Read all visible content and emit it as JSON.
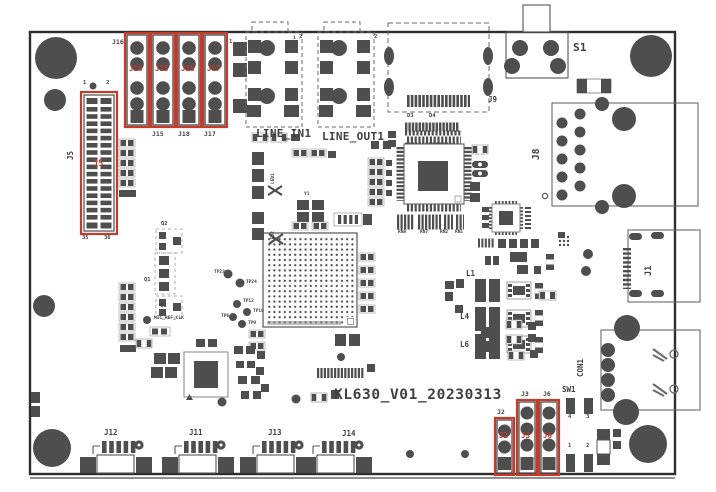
{
  "title": "KL630_V01_20230313",
  "colors": {
    "highlight": "#c23b2b",
    "silk": "#4e4e4e",
    "outline": "#2e2e2e"
  },
  "top_headers": {
    "silk_top_label": "J16",
    "pin1": "1",
    "red_labels": [
      "J16",
      "J15",
      "J18",
      "J17"
    ],
    "silk_bottom_labels": [
      "J15",
      "J18",
      "J17"
    ]
  },
  "j5": {
    "silk": "J5",
    "red": "J5",
    "pins": {
      "tl": "1",
      "tr": "2",
      "bl": "35",
      "br": "36"
    }
  },
  "audio": {
    "line_in": "LINE_IN1",
    "line_out": "LINE_OUT1",
    "pin1": "1",
    "pin2": "2"
  },
  "j9": {
    "label": "J9",
    "d3": "D3",
    "d4": "D4"
  },
  "top_right": {
    "s1": "S1"
  },
  "right": {
    "j8": "J8",
    "j1": "J1",
    "con1": "CON1"
  },
  "sw1": {
    "label": "SW1",
    "pin4": "4",
    "pin3": "3",
    "pin1": "1",
    "pin2": "2"
  },
  "jumpers": {
    "silk": [
      "J2",
      "J3",
      "J6"
    ],
    "red": [
      "J2",
      "J3",
      "J6"
    ]
  },
  "bottom": {
    "connectors": [
      "J12",
      "J11",
      "J13",
      "J14"
    ]
  },
  "center": {
    "q2": "Q2",
    "q1": "Q1",
    "q3": "Q3",
    "net": "MIC_REF_CLK",
    "y1": "Y1",
    "led1": "LED1",
    "led2": "LED2",
    "tp23": "TP23",
    "tp24": "TP24",
    "tp12": "TP12",
    "tp10": "TP10",
    "tp6": "TP6",
    "tp9": "TP9",
    "rn": [
      "RN8",
      "RN7",
      "RN2",
      "RN1"
    ],
    "l1": "L1",
    "l4": "L4",
    "l6": "L6"
  }
}
